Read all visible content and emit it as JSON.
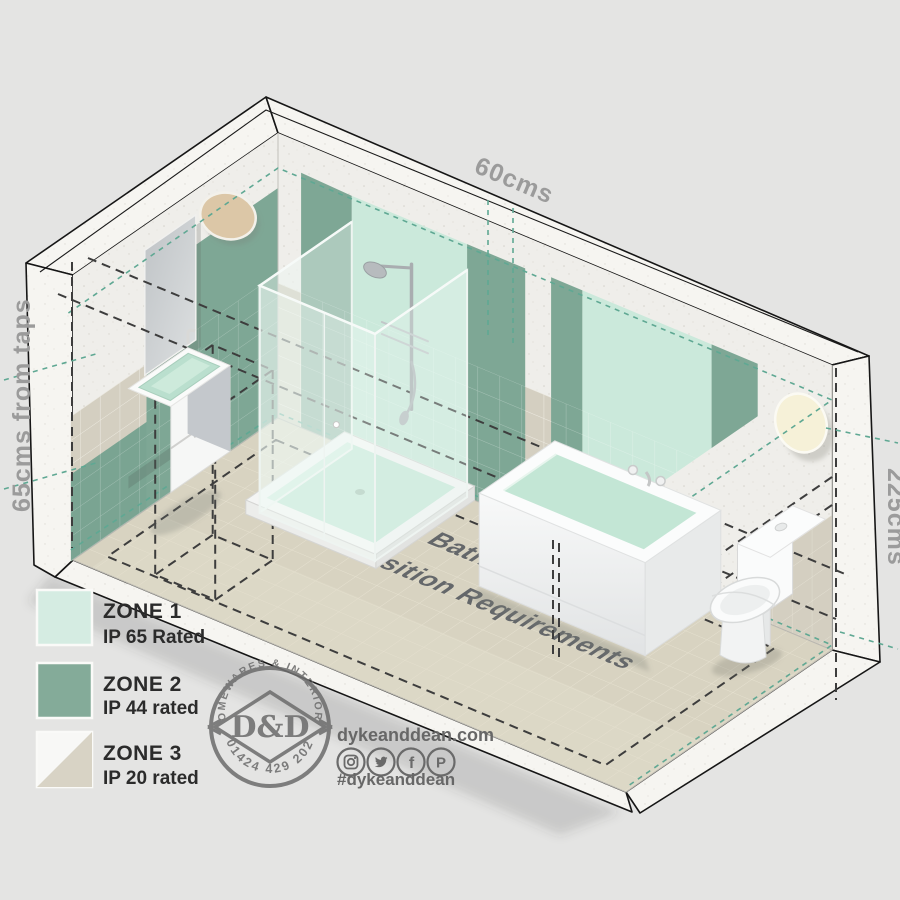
{
  "diagram": {
    "floor_title_line1": "IP Rated Bathroom Lighting",
    "floor_title_line2": "Zone Position Requirements",
    "dim_shower_width": "60cms",
    "dim_taps": "65cms from taps",
    "dim_height": "225cms"
  },
  "legend": {
    "items": [
      {
        "zone": "ZONE 1",
        "rating": "IP 65 Rated",
        "color": "#d5ece2"
      },
      {
        "zone": "ZONE 2",
        "rating": "IP 44 rated",
        "color": "#84ab99"
      },
      {
        "zone": "ZONE 3",
        "rating": "IP 20 rated",
        "color": "#d8d3c5"
      }
    ]
  },
  "logo": {
    "arc_top": "HOMEWARES & INTERIORS",
    "arc_bottom": "01424 429 202",
    "monogram": "D&D"
  },
  "social": {
    "website": "dykeanddean.com",
    "hashtag": "#dykeanddean",
    "icons": [
      "instagram",
      "twitter",
      "facebook",
      "pinterest"
    ]
  },
  "colors": {
    "zone1": "#cbe9db",
    "zone2": "#7ea795",
    "accent_teal": "#5fa893",
    "dash_dark": "#3d3d3d",
    "floor": "#d8d3c1",
    "label_gray": "#9b9b9b"
  }
}
